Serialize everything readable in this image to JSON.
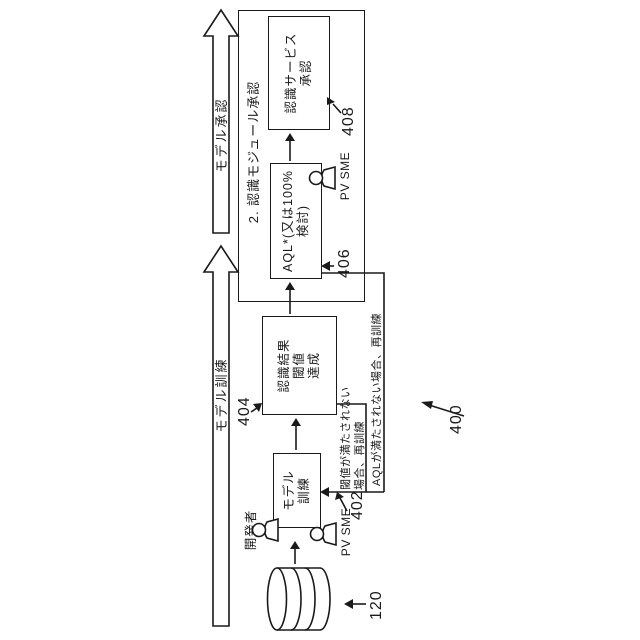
{
  "figure": {
    "phase_arrows": {
      "training": "モデル訓練",
      "approval": "モデル承認"
    },
    "module_box_title": "2. 認識モジュール承認",
    "boxes": {
      "training": {
        "line1": "モデル",
        "line2": "訓練"
      },
      "threshold": {
        "line1": "認識結果",
        "line2": "閾値",
        "line3": "達成"
      },
      "aql": {
        "line1": "AQL*(又は100%",
        "line2": "検討)"
      },
      "service": {
        "line1": "認識サービス",
        "line2": "承認"
      }
    },
    "actors": {
      "developer": "開発者",
      "pv_sme_training": "PV SME",
      "pv_sme_aql": "PV SME"
    },
    "feedback": {
      "threshold_line1": "閾値が満たされない",
      "threshold_line2": "場合、再訓練",
      "aql_line": "AQLが満たされない場合、再訓練"
    },
    "refs": {
      "database": "120",
      "figure": "400",
      "training_box": "402",
      "threshold_box": "404",
      "aql_box": "406",
      "service_box": "408"
    }
  }
}
